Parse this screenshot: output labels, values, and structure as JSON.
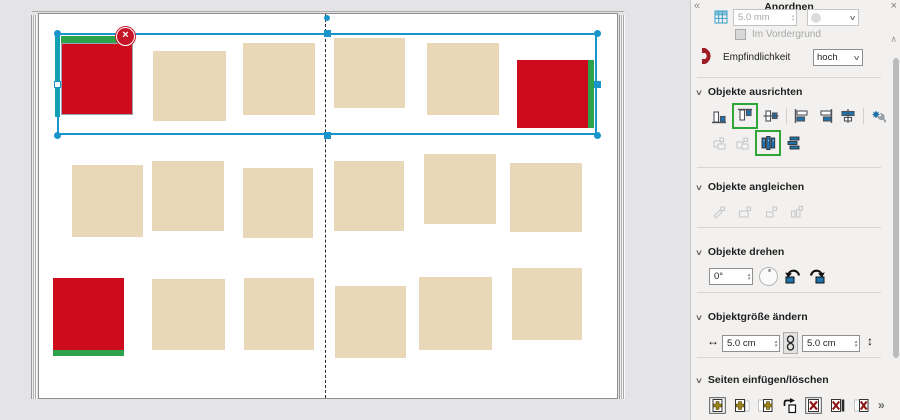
{
  "panel": {
    "title": "Anordnen",
    "collapse": "«",
    "close": "×",
    "scroll_up": "∧",
    "grid": {
      "value": "5.0 mm",
      "dropdown_chevron": "∨",
      "spin_up": "▴",
      "spin_down": "▾"
    },
    "foreground": {
      "label": "Im Vordergrund"
    },
    "sensitivity": {
      "label": "Empfindlichkeit",
      "value": "hoch",
      "chevron": "∨"
    },
    "align": {
      "chevron": "∨",
      "title": "Objekte ausrichten",
      "icons": [
        "align-bottom",
        "align-top",
        "align-middle",
        "align-left",
        "align-right",
        "align-center",
        "align-settings",
        "align-group-left",
        "align-group-top",
        "distribute-horizontal",
        "distribute-vertical"
      ],
      "highlighted": [
        "align-top",
        "distribute-horizontal"
      ]
    },
    "match": {
      "chevron": "∨",
      "title": "Objekte angleichen",
      "icons": [
        "match-style",
        "match-size",
        "match-width",
        "match-height"
      ]
    },
    "rotate": {
      "chevron": "∨",
      "title": "Objekte drehen",
      "angle": "0°",
      "spin_up": "▴",
      "spin_down": "▾",
      "icons": [
        "rotate-dial",
        "rotate-left",
        "rotate-right"
      ]
    },
    "resize": {
      "chevron": "∨",
      "title": "Objektgröße ändern",
      "width_arrow": "↔",
      "width_value": "5.0 cm",
      "link_icon": "chain",
      "height_value": "5.0 cm",
      "height_arrow": "↕",
      "spin_up": "▴",
      "spin_down": "▾"
    },
    "pages": {
      "chevron": "∨",
      "title": "Seiten einfügen/löschen",
      "overflow": "»",
      "icons": [
        "insert-page-boxed",
        "insert-page-after",
        "insert-pages",
        "move-page",
        "delete-page-boxed",
        "delete-page",
        "delete-pages"
      ]
    }
  },
  "canvas": {
    "background": "#e4e4e6",
    "colors": {
      "beige": "#e9d8b8",
      "red": "#ce0a1d",
      "green": "#2ca24b",
      "teal": "#12a0b6",
      "selection": "#1a95cb",
      "badge": "#c51526"
    },
    "page": {
      "x": 38,
      "y": 13,
      "w": 580,
      "h": 386,
      "spine_x": 325
    },
    "objects": [
      {
        "x": 61,
        "y": 43,
        "w": 72,
        "h": 72,
        "fill": "red",
        "strip": "top",
        "border": true
      },
      {
        "x": 153,
        "y": 51,
        "w": 73,
        "h": 70,
        "fill": "beige"
      },
      {
        "x": 243,
        "y": 43,
        "w": 72,
        "h": 72,
        "fill": "beige"
      },
      {
        "x": 334,
        "y": 38,
        "w": 71,
        "h": 70,
        "fill": "beige"
      },
      {
        "x": 427,
        "y": 43,
        "w": 72,
        "h": 72,
        "fill": "beige"
      },
      {
        "x": 517,
        "y": 60,
        "w": 71,
        "h": 68,
        "fill": "red",
        "strip": "right"
      },
      {
        "x": 72,
        "y": 165,
        "w": 71,
        "h": 72,
        "fill": "beige"
      },
      {
        "x": 152,
        "y": 161,
        "w": 72,
        "h": 70,
        "fill": "beige"
      },
      {
        "x": 243,
        "y": 168,
        "w": 70,
        "h": 70,
        "fill": "beige"
      },
      {
        "x": 334,
        "y": 161,
        "w": 70,
        "h": 70,
        "fill": "beige"
      },
      {
        "x": 424,
        "y": 154,
        "w": 72,
        "h": 70,
        "fill": "beige"
      },
      {
        "x": 510,
        "y": 163,
        "w": 72,
        "h": 69,
        "fill": "beige"
      },
      {
        "x": 53,
        "y": 278,
        "w": 71,
        "h": 72,
        "fill": "red",
        "strip": "bottom"
      },
      {
        "x": 152,
        "y": 279,
        "w": 73,
        "h": 71,
        "fill": "beige"
      },
      {
        "x": 244,
        "y": 278,
        "w": 70,
        "h": 72,
        "fill": "beige"
      },
      {
        "x": 335,
        "y": 286,
        "w": 71,
        "h": 72,
        "fill": "beige"
      },
      {
        "x": 419,
        "y": 277,
        "w": 73,
        "h": 73,
        "fill": "beige"
      },
      {
        "x": 512,
        "y": 268,
        "w": 70,
        "h": 72,
        "fill": "beige"
      }
    ],
    "selection": {
      "x": 57,
      "y": 33,
      "w": 540,
      "h": 102
    },
    "teal_bar": {
      "x": 55,
      "y": 33,
      "w": 5,
      "h": 84
    },
    "spine_dot": {
      "cx": 327,
      "cy": 18
    },
    "delete_badge": {
      "cx": 125,
      "cy": 36,
      "label": "×"
    }
  }
}
